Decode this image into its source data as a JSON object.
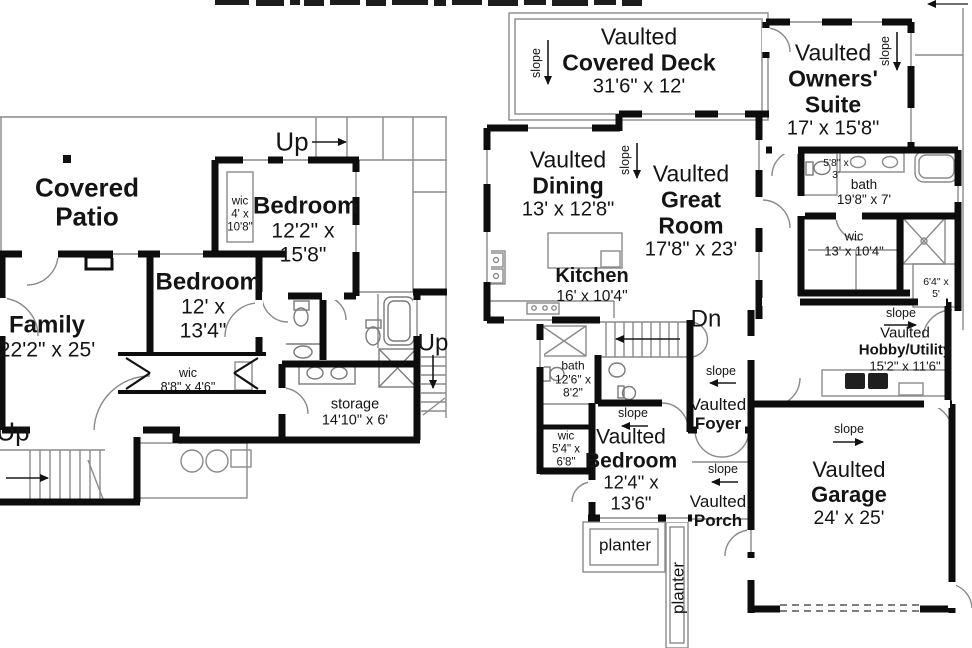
{
  "left_plan": {
    "rooms": [
      {
        "prefix": "",
        "name": "Covered Patio",
        "dims": ""
      },
      {
        "prefix": "",
        "name": "Bedroom",
        "dims": "12'2\" x 15'8\""
      },
      {
        "prefix": "",
        "name": "Bedroom",
        "dims": "12' x 13'4\""
      },
      {
        "prefix": "",
        "name": "Family",
        "dims": "22'2\" x 25'"
      },
      {
        "prefix": "",
        "name": "wic",
        "dims": "4' x 10'8\""
      },
      {
        "prefix": "",
        "name": "wic",
        "dims": "8'8\" x 4'6\""
      },
      {
        "prefix": "",
        "name": "storage",
        "dims": "14'10\" x 6'"
      }
    ],
    "stair_labels": [
      "Up",
      "Up",
      "Up"
    ]
  },
  "right_plan": {
    "rooms": [
      {
        "prefix": "Vaulted",
        "name": "Covered Deck",
        "dims": "31'6\" x 12'"
      },
      {
        "prefix": "Vaulted",
        "name": "Owners' Suite",
        "dims": "17' x 15'8\""
      },
      {
        "prefix": "Vaulted",
        "name": "Dining",
        "dims": "13' x 12'8\""
      },
      {
        "prefix": "Vaulted",
        "name": "Great Room",
        "dims": "17'8\" x 23'"
      },
      {
        "prefix": "",
        "name": "Kitchen",
        "dims": "16' x 10'4\""
      },
      {
        "prefix": "",
        "name": "bath",
        "dims": "19'8\" x 7'"
      },
      {
        "prefix": "",
        "name": "wic",
        "dims": "13' x 10'4\""
      },
      {
        "prefix": "",
        "name": "bath",
        "dims": "12'6\" x 8'2\""
      },
      {
        "prefix": "",
        "name": "wic",
        "dims": "5'4\" x 6'8\""
      },
      {
        "prefix": "Vaulted",
        "name": "Bedroom",
        "dims": "12'4\" x 13'6\""
      },
      {
        "prefix": "Vaulted",
        "name": "Foyer",
        "dims": ""
      },
      {
        "prefix": "Vaulted",
        "name": "Porch",
        "dims": ""
      },
      {
        "prefix": "Vaulted",
        "name": "Hobby/Utility",
        "dims": "15'2\" x 11'6\""
      },
      {
        "prefix": "Vaulted",
        "name": "Garage",
        "dims": "24' x 25'"
      }
    ],
    "closets": [
      {
        "dims": "5'8\" x 3'"
      },
      {
        "dims": "6'4\" x 5'"
      }
    ],
    "stair_label": "Dn",
    "slope_label": "slope",
    "planter_label": "planter"
  }
}
